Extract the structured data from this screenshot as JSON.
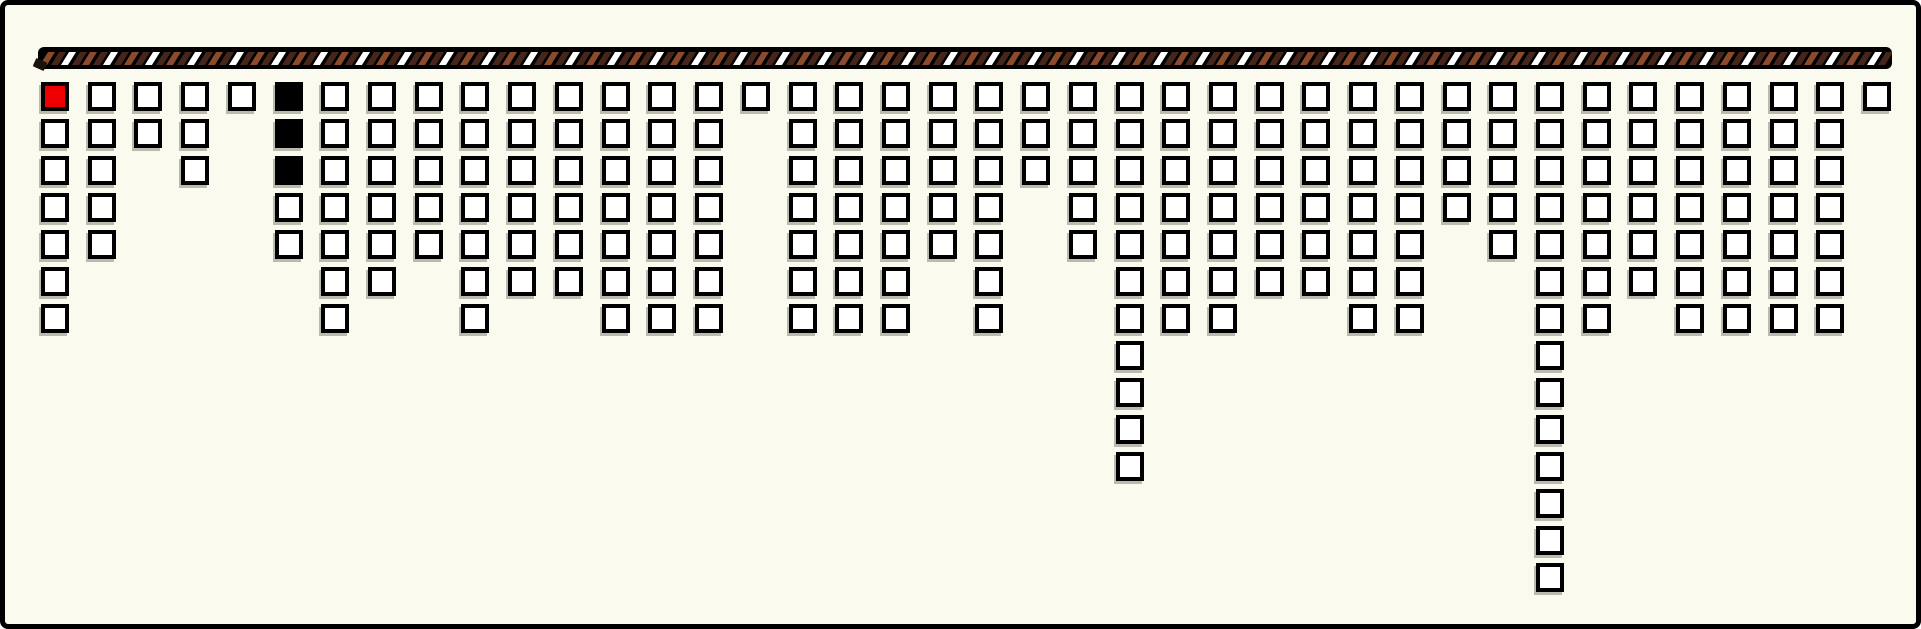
{
  "chart_data": {
    "type": "bar",
    "subtype": "hanging-unit-pictograph",
    "title": "",
    "xlabel": "",
    "ylabel": "",
    "legend": false,
    "grid": false,
    "columns": 40,
    "unit_shape": "square",
    "values": [
      7,
      5,
      2,
      3,
      1,
      5,
      7,
      6,
      5,
      7,
      6,
      6,
      7,
      7,
      7,
      1,
      7,
      7,
      7,
      5,
      7,
      3,
      5,
      11,
      7,
      7,
      6,
      6,
      7,
      7,
      4,
      5,
      14,
      7,
      6,
      7,
      7,
      7,
      7,
      1
    ],
    "total_units": 239,
    "max_units_in_column": 14,
    "special_units": [
      {
        "column": 1,
        "row": 1,
        "name": "red-unit-square",
        "color": "#ee0000"
      },
      {
        "column": 6,
        "row": 1,
        "name": "black-unit-square",
        "color": "#000000"
      },
      {
        "column": 6,
        "row": 2,
        "name": "black-unit-square",
        "color": "#000000"
      },
      {
        "column": 6,
        "row": 3,
        "name": "black-unit-square",
        "color": "#000000"
      }
    ]
  },
  "rope": {
    "bar_color": "#000000",
    "stripe_pattern": [
      "#8b4a2b",
      "#46261a",
      "#ffffff",
      "#46261a"
    ]
  },
  "colors": {
    "background": "#fbfaee",
    "frame_border": "#000000",
    "unit_border": "#000000",
    "unit_fill": "#ffffff",
    "highlight_red": "#ee0000",
    "filled_black": "#000000",
    "unit_shadow": "#6e6c5f"
  }
}
